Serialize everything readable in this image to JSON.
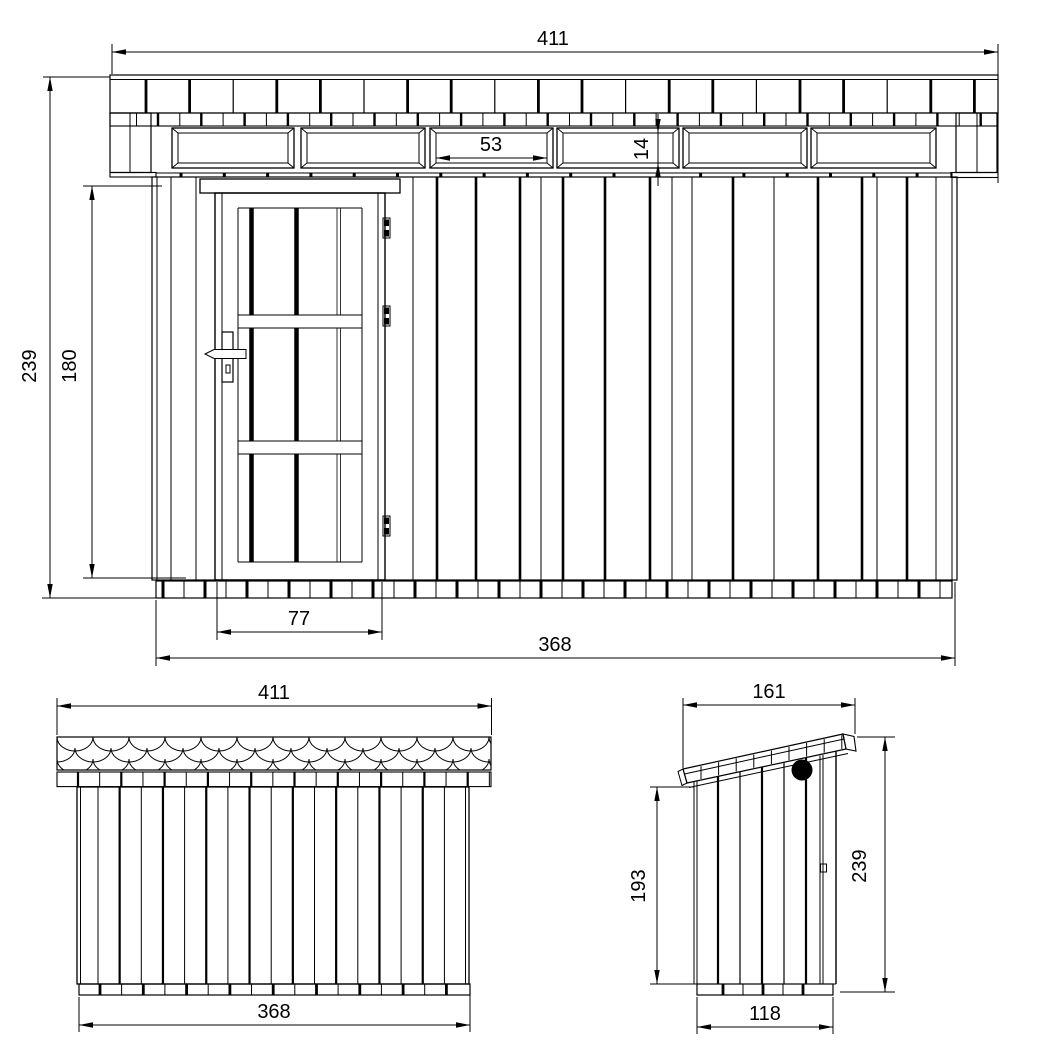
{
  "drawing": {
    "background_color": "#ffffff",
    "line_color": "#000000",
    "views": {
      "front_elevation": {
        "dimensions": {
          "overall_width": "411",
          "overall_height": "239",
          "wall_height": "180",
          "transom_window_width": "53",
          "transom_window_height": "14",
          "door_width": "77",
          "base_width": "368"
        }
      },
      "rear_elevation": {
        "dimensions": {
          "roof_width": "411",
          "wall_width": "368"
        }
      },
      "side_elevation": {
        "dimensions": {
          "roof_depth": "161",
          "rear_wall_height": "193",
          "overall_height": "239",
          "base_depth": "118"
        }
      }
    }
  }
}
